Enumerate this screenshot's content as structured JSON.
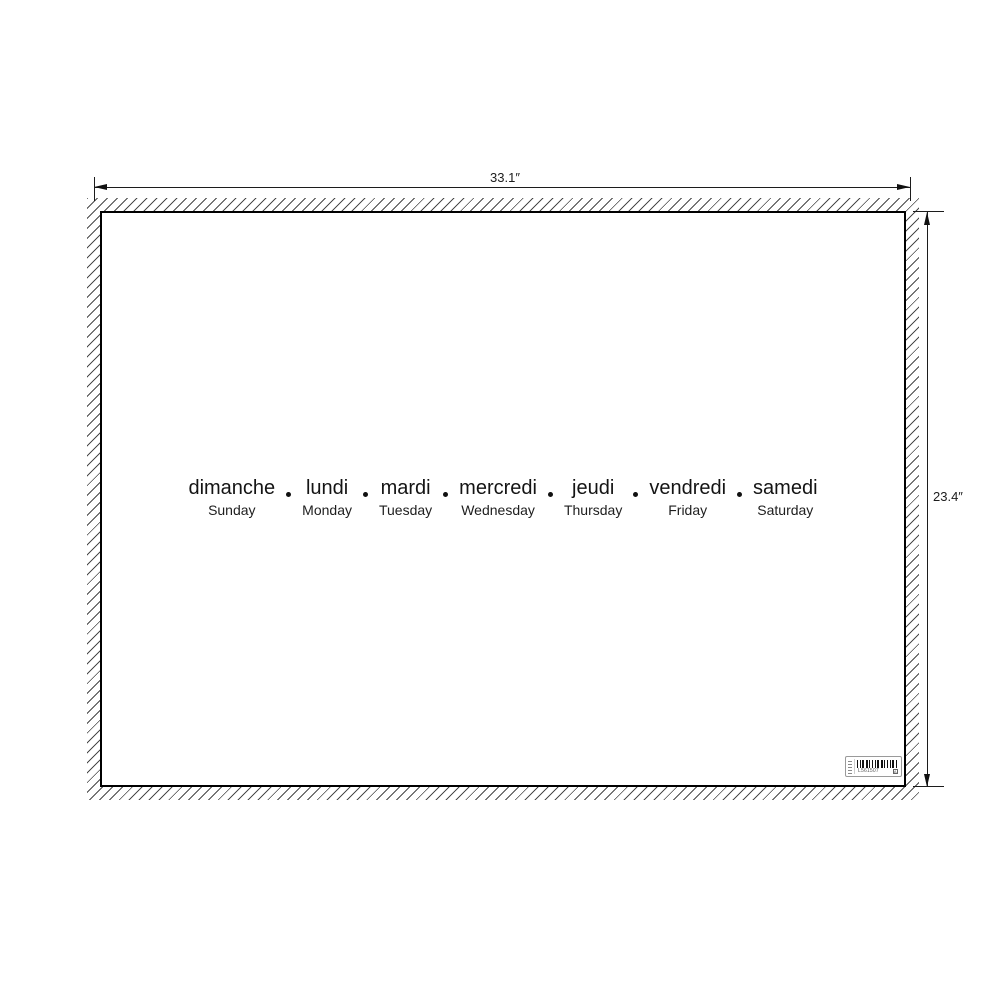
{
  "dims": {
    "width_label": "33.1″",
    "height_label": "23.4″"
  },
  "poster": {
    "days": [
      {
        "fr": "dimanche",
        "en": "Sunday"
      },
      {
        "fr": "lundi",
        "en": "Monday"
      },
      {
        "fr": "mardi",
        "en": "Tuesday"
      },
      {
        "fr": "mercredi",
        "en": "Wednesday"
      },
      {
        "fr": "jeudi",
        "en": "Thursday"
      },
      {
        "fr": "vendredi",
        "en": "Friday"
      },
      {
        "fr": "samedi",
        "en": "Saturday"
      }
    ],
    "barcode": {
      "code": "L561507",
      "box_char": "A"
    }
  },
  "colors": {
    "background": "#ffffff",
    "ink": "#141414",
    "dimension_line": "#1c1c1c",
    "hatch_line": "#4a4a4a",
    "poster_border": "#000000",
    "label_border": "#9a9a9a"
  }
}
